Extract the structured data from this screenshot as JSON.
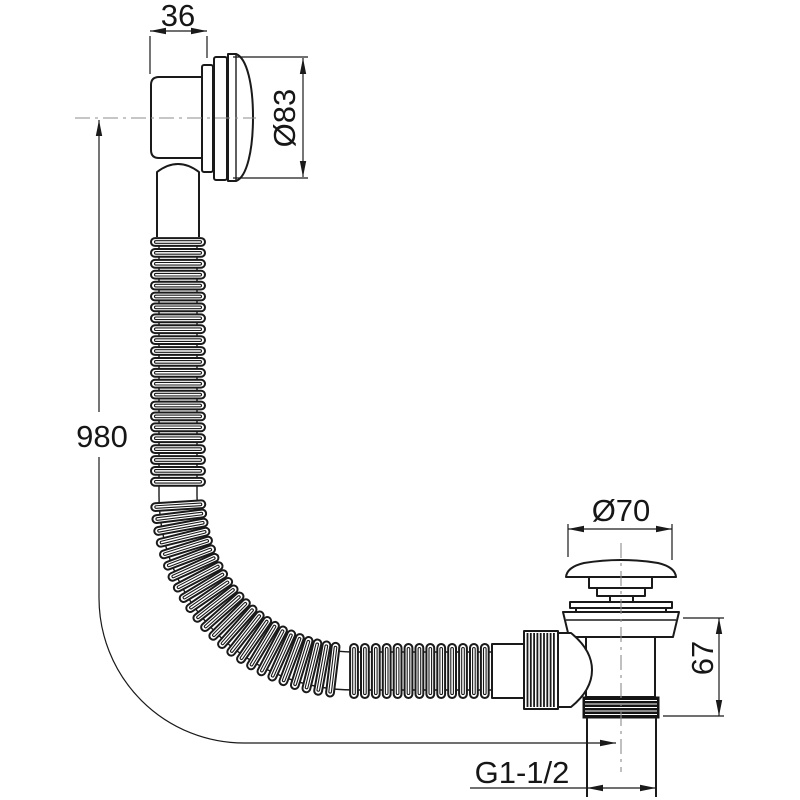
{
  "drawing": {
    "dimensions": {
      "overflow_width": "36",
      "overflow_diameter": "Ø83",
      "hose_length": "980",
      "plug_diameter": "Ø70",
      "waste_height": "67",
      "thread_size": "G1-1/2"
    },
    "colors": {
      "line": "#1a1a1a",
      "background": "#ffffff",
      "centerline": "#8c8c8c"
    }
  }
}
